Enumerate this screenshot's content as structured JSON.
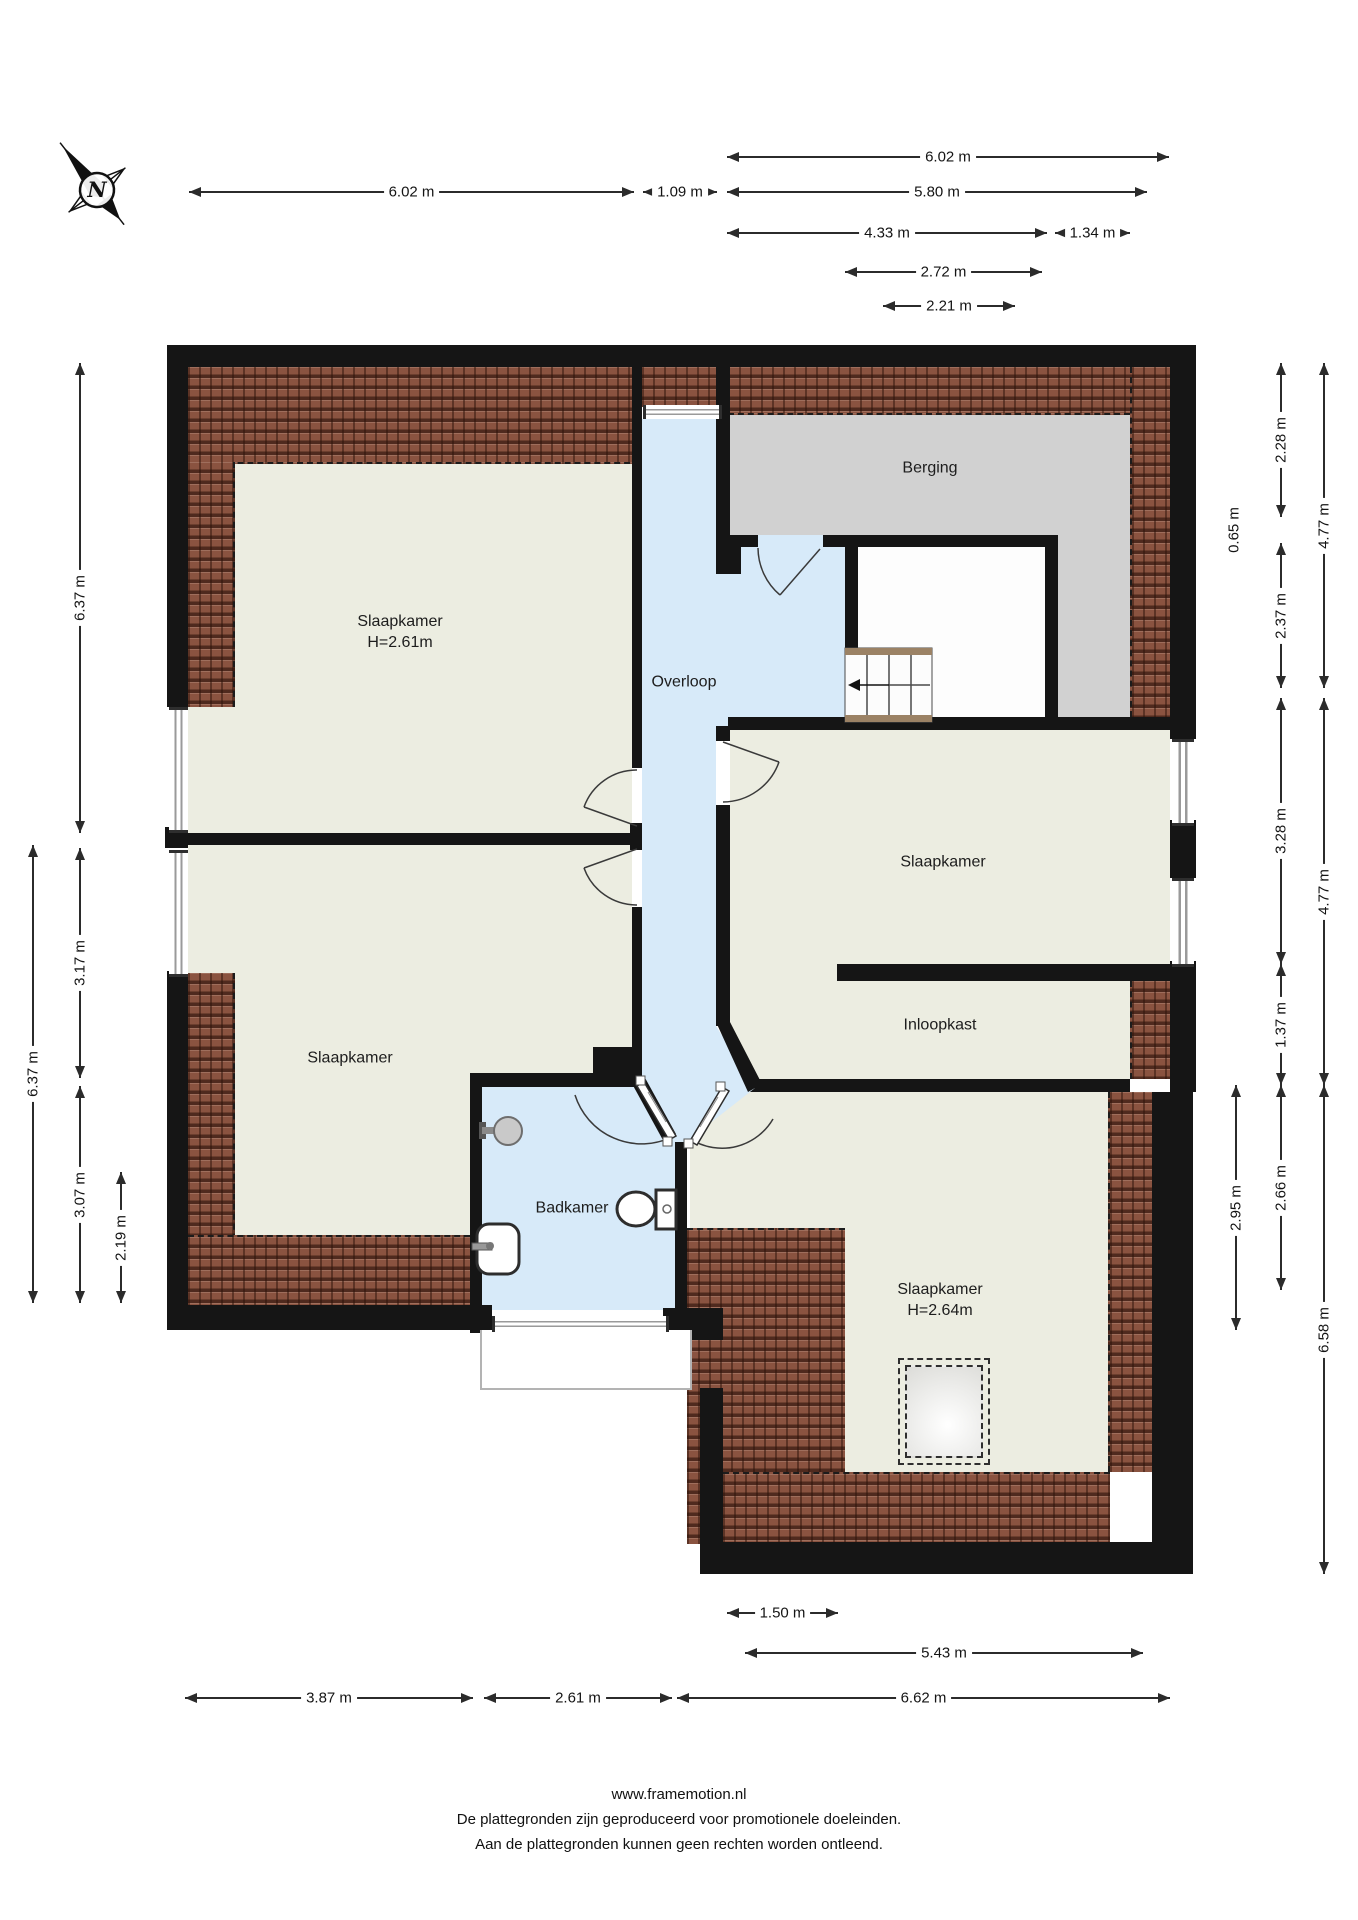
{
  "title": "Floor plan (verdieping)",
  "compass": {
    "letter": "N"
  },
  "rooms": [
    {
      "name": "slaapkamer-top-left",
      "label": "Slaapkamer",
      "sub": "H=2.61m"
    },
    {
      "name": "overloop",
      "label": "Overloop"
    },
    {
      "name": "berging",
      "label": "Berging"
    },
    {
      "name": "slaapkamer-right",
      "label": "Slaapkamer"
    },
    {
      "name": "inloopkast",
      "label": "Inloopkast"
    },
    {
      "name": "slaapkamer-bottom-left",
      "label": "Slaapkamer"
    },
    {
      "name": "badkamer",
      "label": "Badkamer"
    },
    {
      "name": "slaapkamer-bottom-right",
      "label": "Slaapkamer",
      "sub": "H=2.64m"
    }
  ],
  "dimensions": {
    "top": [
      {
        "label": "6.02 m"
      },
      {
        "label": "6.02 m"
      },
      {
        "label": "1.09 m"
      },
      {
        "label": "5.80 m"
      },
      {
        "label": "4.33 m"
      },
      {
        "label": "1.34 m"
      },
      {
        "label": "2.72 m"
      },
      {
        "label": "2.21 m"
      }
    ],
    "left": [
      {
        "label": "6.37 m"
      },
      {
        "label": "3.17 m"
      },
      {
        "label": "3.07 m"
      },
      {
        "label": "2.19 m"
      },
      {
        "label": "6.37 m"
      }
    ],
    "right": [
      {
        "label": "2.28 m"
      },
      {
        "label": "0.65 m"
      },
      {
        "label": "2.37 m"
      },
      {
        "label": "4.77 m"
      },
      {
        "label": "3.28 m"
      },
      {
        "label": "1.37 m"
      },
      {
        "label": "4.77 m"
      },
      {
        "label": "2.95 m"
      },
      {
        "label": "2.66 m"
      },
      {
        "label": "6.58 m"
      }
    ],
    "bottom": [
      {
        "label": "1.50 m"
      },
      {
        "label": "5.43 m"
      },
      {
        "label": "3.87 m"
      },
      {
        "label": "2.61 m"
      },
      {
        "label": "6.62 m"
      }
    ]
  },
  "footer": {
    "line1": "www.framemotion.nl",
    "line2": "De plattegronden zijn geproduceerd voor promotionele doeleinden.",
    "line3": "Aan de plattegronden kunnen geen rechten worden ontleend."
  },
  "colors": {
    "wall": "#151515",
    "floor": "#ECEDE1",
    "wet_area": "#D7EAF9",
    "storage": "#D1D1D1",
    "roof_tile": "#8A5340"
  }
}
